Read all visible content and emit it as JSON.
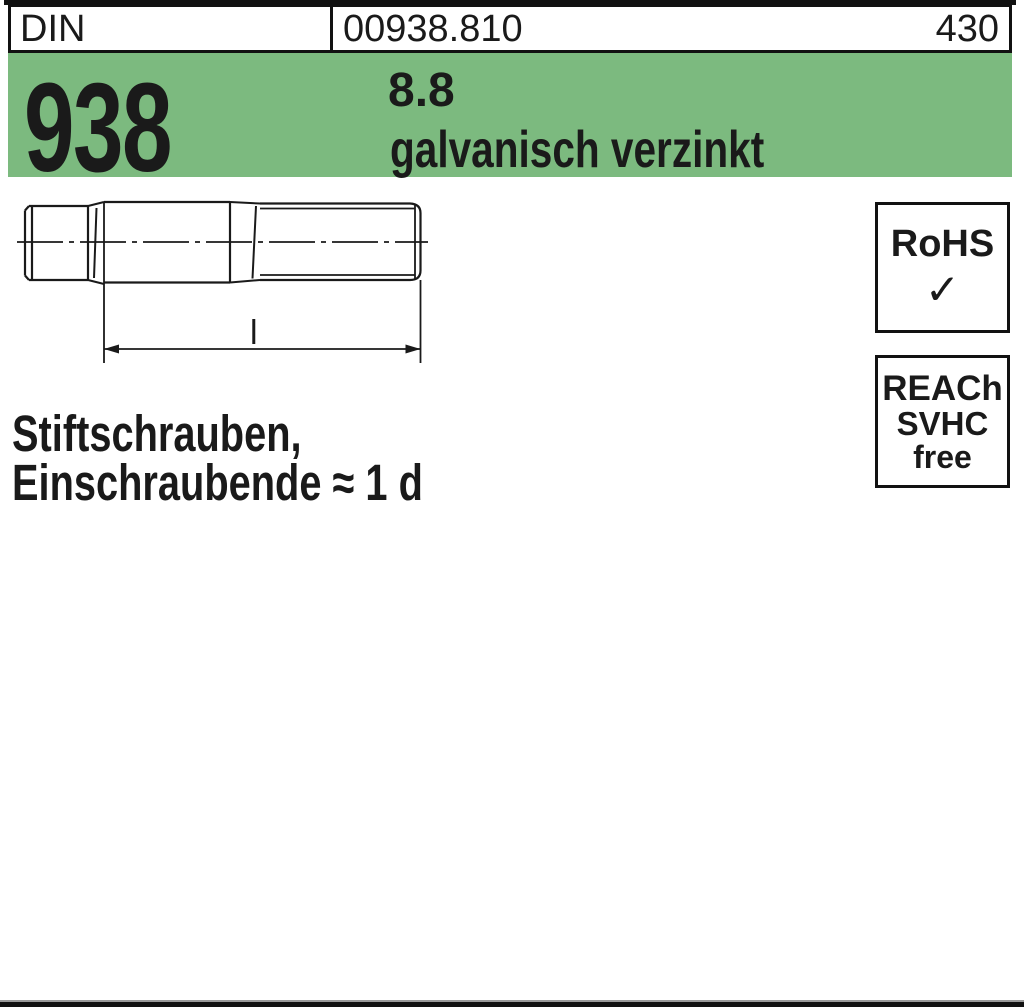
{
  "colors": {
    "banner_green": "#7cba7f",
    "line_black": "#1a1a1a"
  },
  "header": {
    "din_label": "DIN",
    "article_number": "00938.810",
    "page_number": "430"
  },
  "banner": {
    "standard_number": "938",
    "strength_class": "8.8",
    "surface_finish": "galvanisch verzinkt"
  },
  "drawing": {
    "dimension_label": "l"
  },
  "badges": {
    "rohs": {
      "label": "RoHS",
      "check": "✓"
    },
    "reach": {
      "line1": "REACh",
      "line2": "SVHC",
      "line3": "free"
    }
  },
  "description": {
    "line1": "Stiftschrauben,",
    "line2": "Einschraubende ≈ 1 d"
  }
}
